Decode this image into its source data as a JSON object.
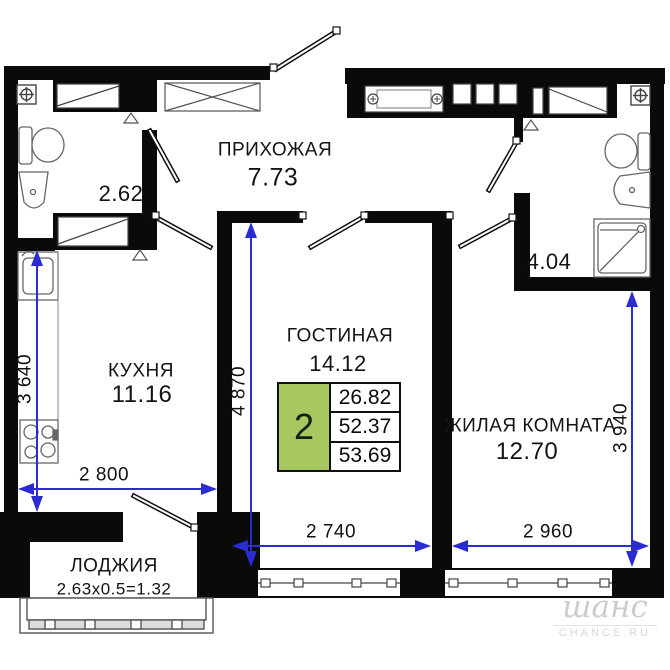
{
  "rooms": {
    "hallway": {
      "label": "ПРИХОЖАЯ",
      "area": "7.73"
    },
    "bath_small": {
      "area": "2.62"
    },
    "bath_big": {
      "area": "4.04"
    },
    "kitchen": {
      "label": "КУХНЯ",
      "area": "11.16"
    },
    "living": {
      "label": "ГОСТИНАЯ",
      "area": "14.12"
    },
    "bedroom": {
      "label": "ЖИЛАЯ КОМНАТА",
      "area": "12.70"
    },
    "loggia": {
      "label": "ЛОДЖИЯ",
      "area": "2.63x0.5=1.32"
    }
  },
  "dimensions": {
    "kitchen_depth": "3 640",
    "kitchen_width": "2 800",
    "living_depth": "4 870",
    "living_width": "2 740",
    "bedroom_width": "2 960",
    "bedroom_depth": "3 940"
  },
  "info_box": {
    "rooms_count": "2",
    "living_area": "26.82",
    "apartment_area": "52.37",
    "total_area": "53.69"
  },
  "watermark": {
    "brand": "шанс",
    "site": "CHANCE.RU"
  },
  "colors": {
    "wall_black": "#0a0a0a",
    "dimension_blue": "#2b2bd4",
    "info_green": "#a6c85e",
    "fixture_gray": "#555555",
    "watermark_gray": "#cccccc"
  }
}
